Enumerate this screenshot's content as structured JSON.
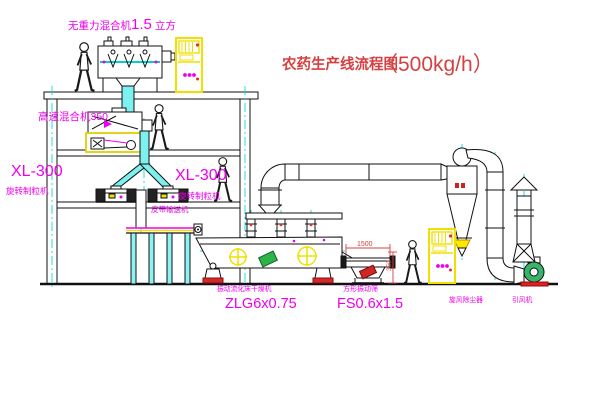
{
  "title": {
    "name": "农药生产线流程图",
    "capacity": "（500kg/h）"
  },
  "equipment": {
    "gravity_mixer": {
      "prefix": "无重力混合机",
      "value": "1.5",
      "suffix": "立方"
    },
    "high_speed_mixer": {
      "label": "高速混合机350"
    },
    "granulator_left": {
      "model": "XL-300",
      "name": "旋转制粒机"
    },
    "granulator_right": {
      "model": "XL-300",
      "name": "旋转制粒机"
    },
    "belt_conveyor": {
      "name": "皮带输送机"
    },
    "dryer": {
      "name": "振动流化床干燥机",
      "model": "ZLG6x0.75"
    },
    "sieve": {
      "name": "方形振动筛",
      "model": "FS0.6x1.5",
      "dim_width": "1500",
      "dim_height": "350"
    },
    "cyclone": {
      "name": "旋风除尘器"
    },
    "fan": {
      "name": "引风机"
    }
  },
  "colors": {
    "label_magenta": "#ee00ee",
    "title_red": "#d64040",
    "line_cyan": "#00dede",
    "cabinet_yellow": "#f0e000",
    "accent_red": "#e23030",
    "fan_green": "#2db34a"
  }
}
